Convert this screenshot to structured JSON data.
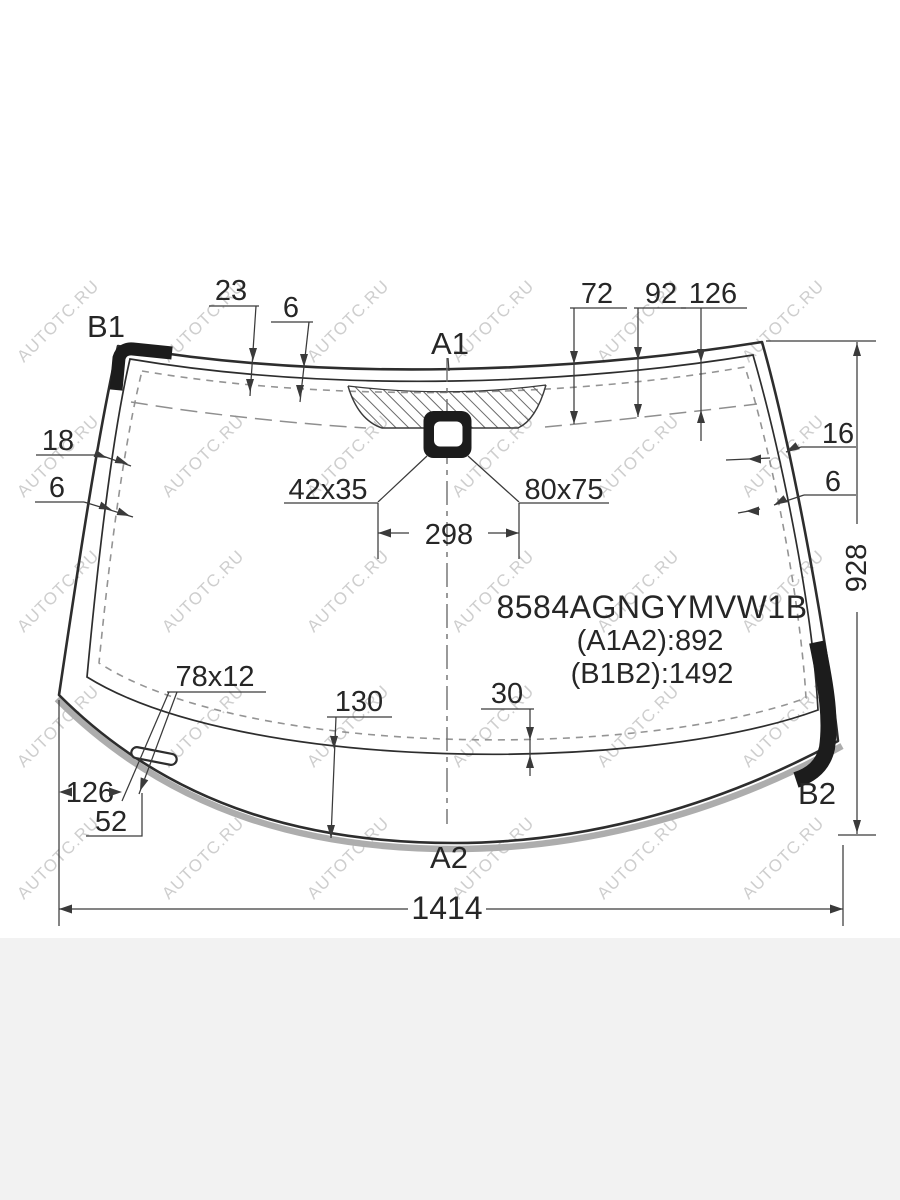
{
  "watermark": {
    "text": "AUTOTC.RU"
  },
  "part": {
    "code": "8584AGNGYMVW1B",
    "a_span": "(A1A2):892",
    "b_span": "(B1B2):1492"
  },
  "corners": {
    "top_left": "B1",
    "top_center": "A1",
    "bottom_right": "B2",
    "bottom_center": "A2"
  },
  "dims": {
    "top_23": "23",
    "top_6": "6",
    "top_72": "72",
    "top_92": "92",
    "top_126": "126",
    "left_18": "18",
    "left_6": "6",
    "right_16": "16",
    "right_6": "6",
    "height_928": "928",
    "bracket_42x35": "42x35",
    "bracket_80x75": "80x75",
    "width_298": "298",
    "slot_78x12": "78x12",
    "bottom_130": "130",
    "bottom_30": "30",
    "bottom_126": "126",
    "bottom_52": "52",
    "width_1414": "1414"
  },
  "colors": {
    "line": "#2d2d2d",
    "dash": "#949494",
    "glass_edge_gray": "#adadad",
    "watermark": "#c3c3c3",
    "footer_band": "#f2f2f2",
    "text": "#262626"
  }
}
